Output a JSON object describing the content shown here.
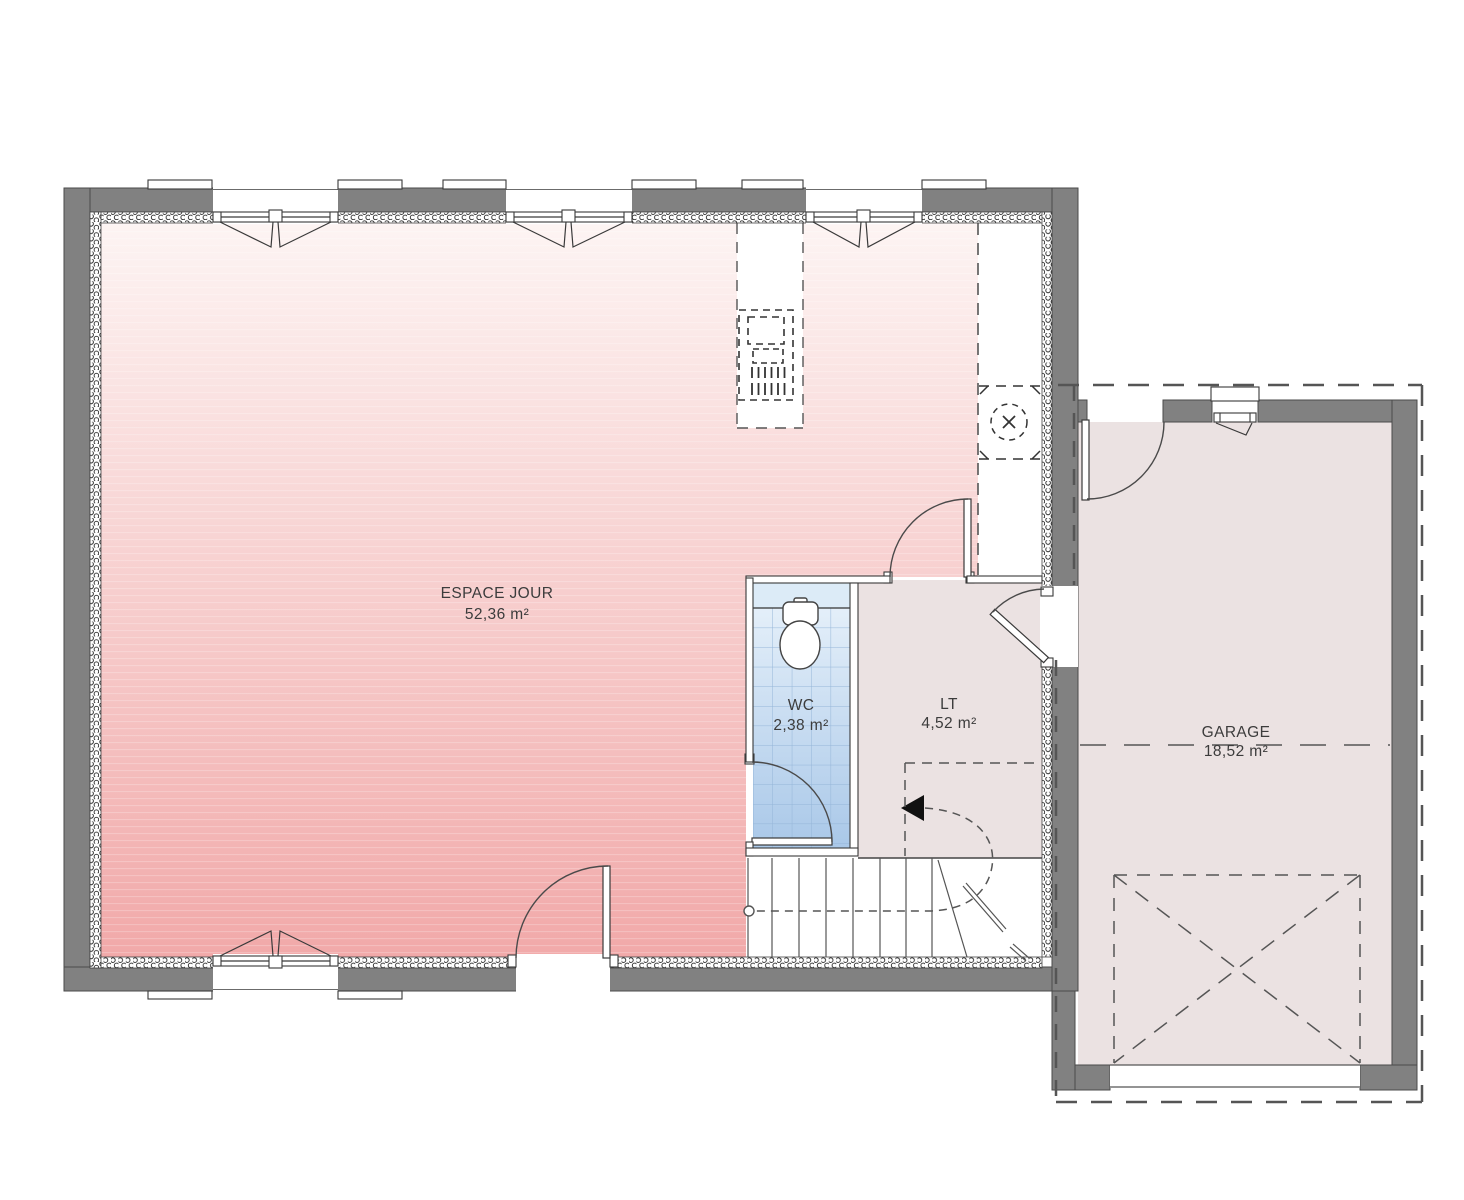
{
  "plan_title": "floor-plan-ground-level",
  "rooms": {
    "espace_jour": {
      "name": "ESPACE JOUR",
      "area": "52,36 m²"
    },
    "wc": {
      "name": "WC",
      "area": "2,38 m²"
    },
    "lt": {
      "name": "LT",
      "area": "4,52 m²"
    },
    "garage": {
      "name": "GARAGE",
      "area": "18,52 m²"
    }
  },
  "colors": {
    "wall": "#818181",
    "floor_pink_top": "#fdf4f3",
    "floor_pink_bottom": "#f1a9a9",
    "floor_neutral": "#ebe2e2",
    "wc_blue_top": "#eaf3fb",
    "wc_blue_bottom": "#a8c7e8",
    "wc_band": "#dcebf7",
    "label_text": "#3c3c3c"
  }
}
